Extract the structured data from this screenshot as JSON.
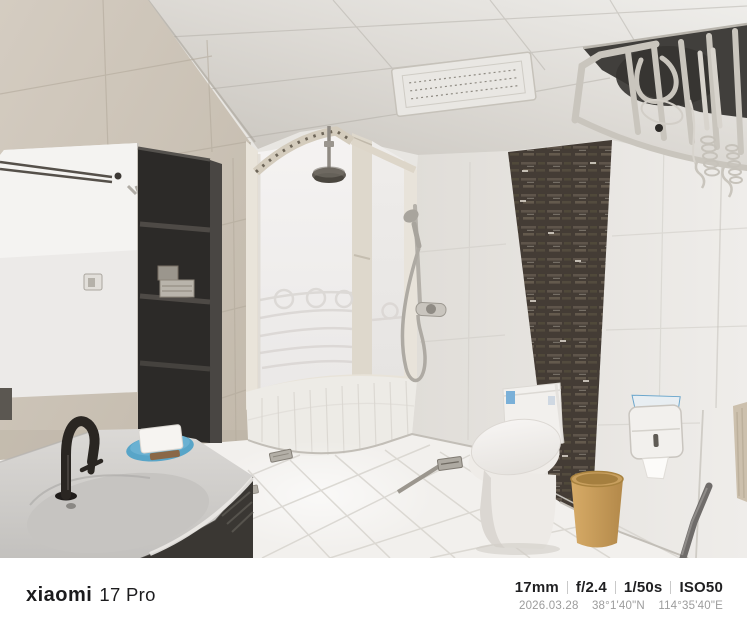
{
  "device_watermark": {
    "brand": "xiaomi",
    "model": "17 Pro",
    "settings": {
      "focal": "17mm",
      "aperture": "f/2.4",
      "shutter": "1/50s",
      "iso": "ISO50"
    },
    "capture": {
      "date": "2026.03.28",
      "lat": "38°1'40\"N",
      "lon": "114°35'40\"E"
    }
  },
  "scene": {
    "type": "bathroom-interior-photo",
    "objects": [
      "ceiling-vent",
      "ceiling-drying-rack",
      "rain-shower-head",
      "bay-window",
      "mirror",
      "wall-cabinet",
      "hand-shower-set",
      "mosaic-accent-wall",
      "toilet",
      "trash-bin",
      "paper-dispenser",
      "hanging-towel",
      "vanity-counter",
      "sink-faucet",
      "soap-dish",
      "vanity-cabinet",
      "floor-drain",
      "tile-floor"
    ]
  },
  "colors": {
    "watermark_bg": "#ffffff",
    "watermark_text": "#1c1c1e",
    "watermark_meta": "#9c9c9c",
    "wall_beige": "#cfc7bb",
    "mosaic_dark": "#49413a",
    "bin_tan": "#c89f5e",
    "soap_dish_blue": "#58a5c8",
    "floor_white": "#f2f0ed"
  }
}
